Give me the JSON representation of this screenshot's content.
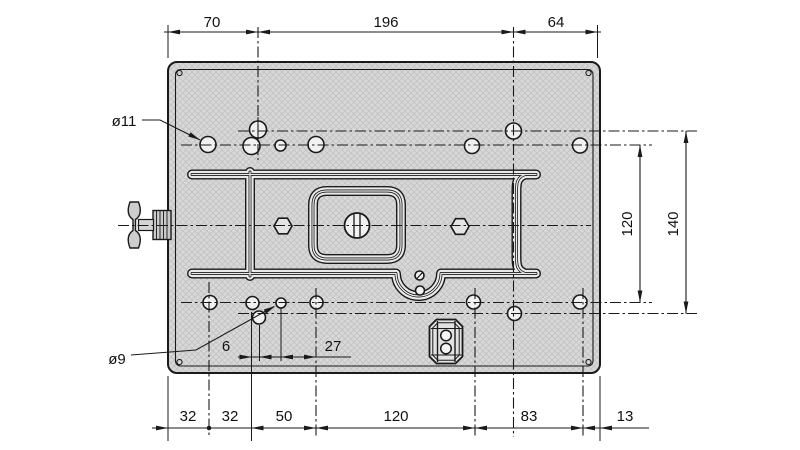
{
  "drawing": {
    "type": "technical-drawing",
    "subject": "mounting-plate-top-view",
    "labels": {
      "large_hole_diameter": "ø11",
      "small_hole_diameter": "ø9"
    },
    "dimensions": {
      "top": [
        "70",
        "196",
        "64"
      ],
      "right": [
        "120",
        "140"
      ],
      "bottom": [
        "32",
        "32",
        "50",
        "120",
        "83",
        "13"
      ],
      "detail": [
        "6",
        "27"
      ]
    },
    "colors": {
      "line": "#1a1a1a",
      "plate_fill": "#d8d8d8",
      "groove_fill": "#e9e9e9",
      "background": "#ffffff"
    }
  }
}
